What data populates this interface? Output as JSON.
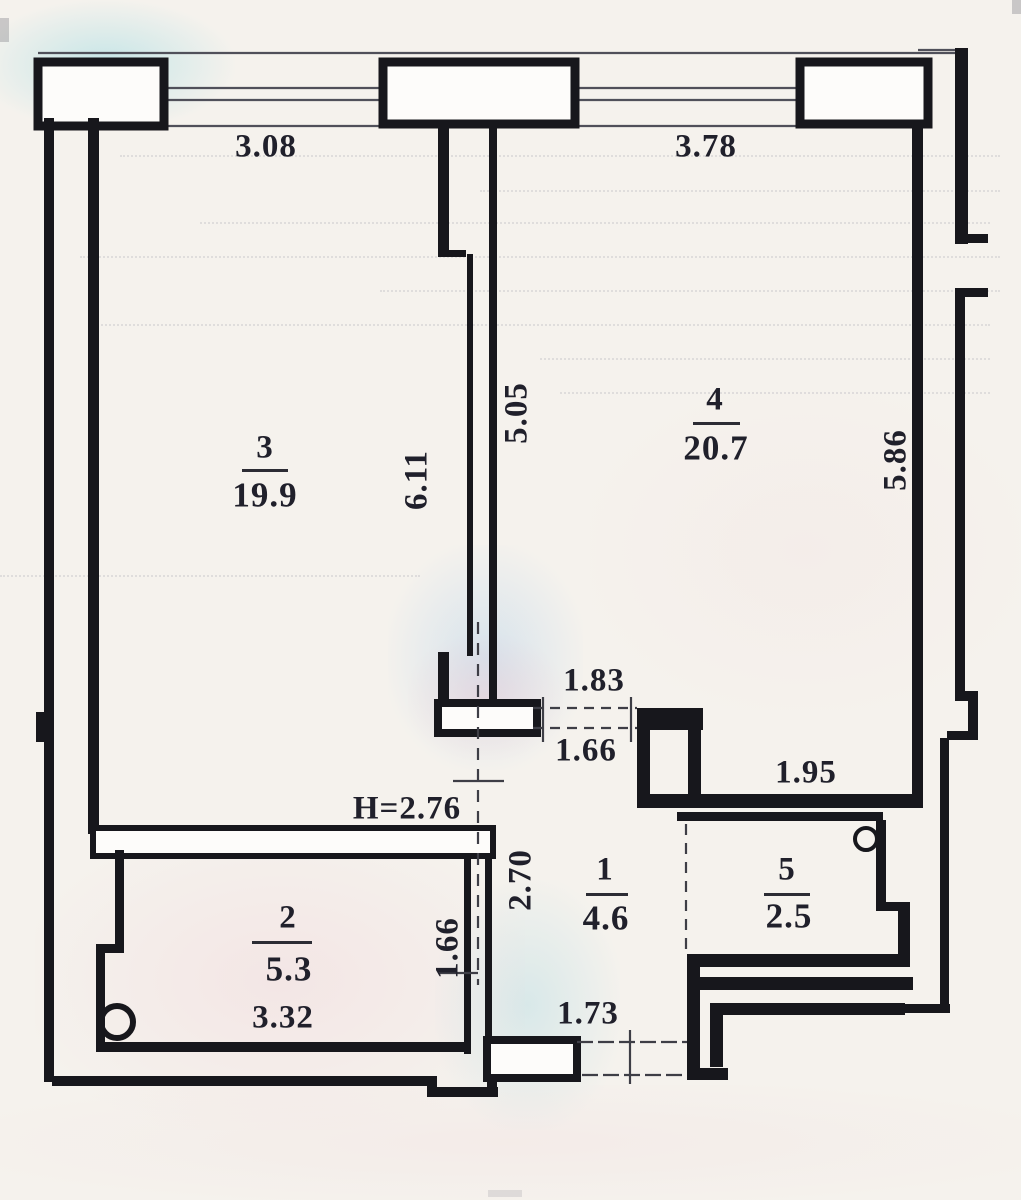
{
  "plan": {
    "rooms": [
      {
        "number": "1",
        "area": "4.6"
      },
      {
        "number": "2",
        "area": "5.3"
      },
      {
        "number": "3",
        "area": "19.9"
      },
      {
        "number": "4",
        "area": "20.7"
      },
      {
        "number": "5",
        "area": "2.5"
      }
    ],
    "dimensions": {
      "top_window_left": "3.08",
      "top_window_right": "3.78",
      "room3_right_wall": "6.11",
      "room4_left_wall": "5.05",
      "room4_right_wall": "5.86",
      "room4_door_outer": "1.83",
      "room4_door_inner": "1.66",
      "room4_alcove_width": "1.95",
      "ceiling_height": "H=2.76",
      "hall_left_wall": "2.70",
      "room2_right_wall": "1.66",
      "room2_width": "3.32",
      "entry_opening": "1.73"
    }
  }
}
